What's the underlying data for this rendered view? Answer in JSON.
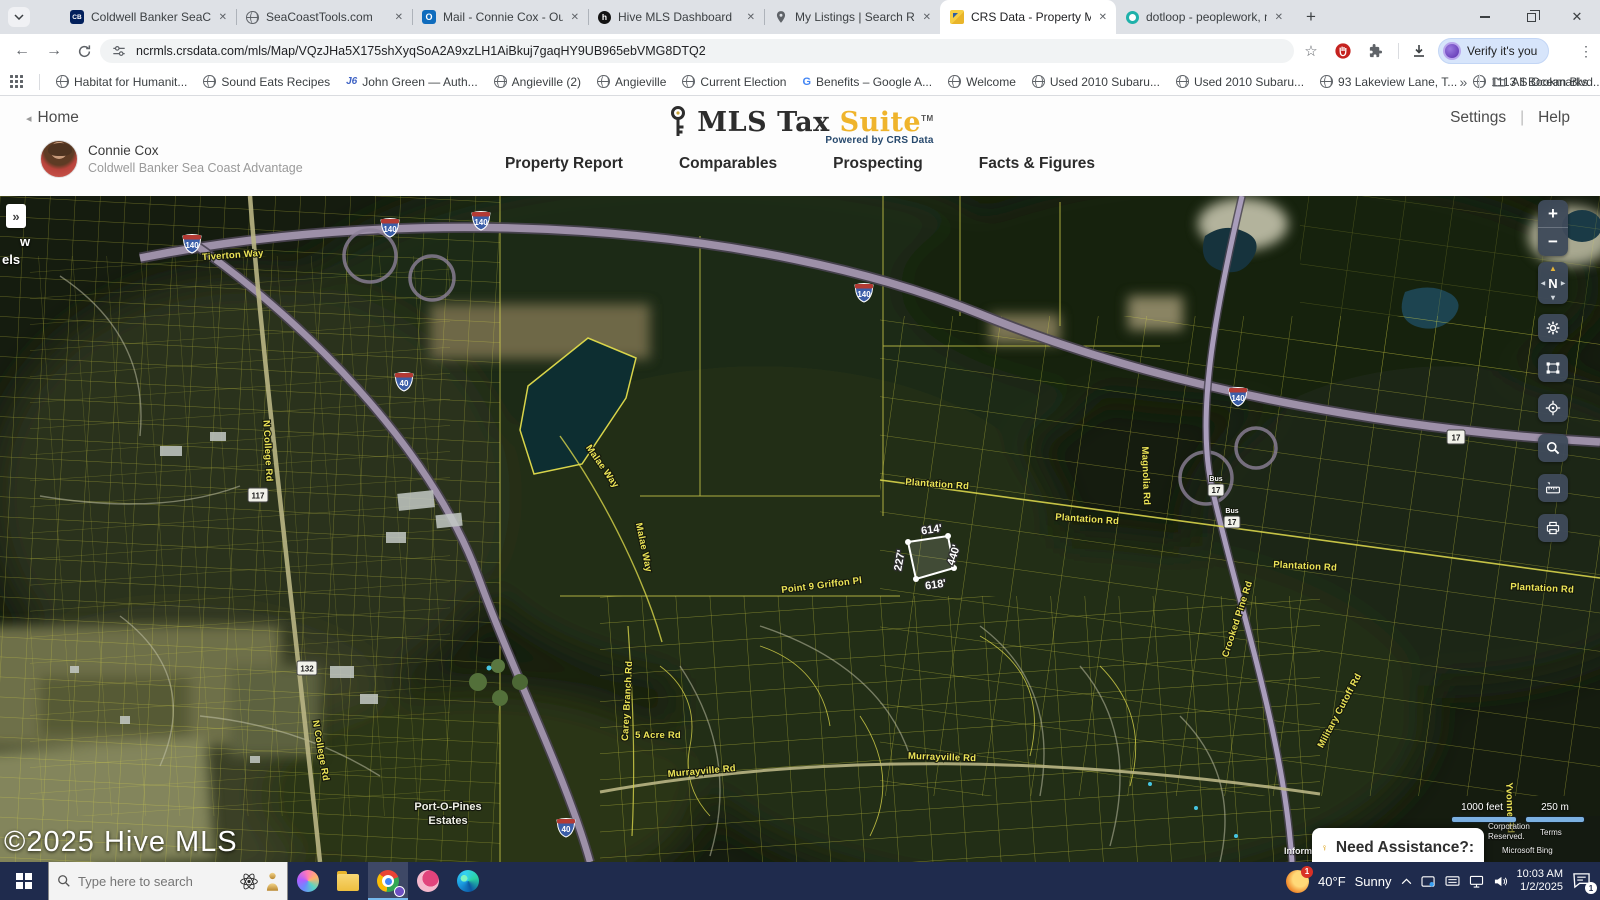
{
  "browser": {
    "tabs": [
      {
        "label": "Coldwell Banker SeaCoast Adva",
        "icon": "coldwell-banker"
      },
      {
        "label": "SeaCoastTools.com",
        "icon": "globe"
      },
      {
        "label": "Mail - Connie Cox - Outlook",
        "icon": "outlook"
      },
      {
        "label": "Hive MLS Dashboard",
        "icon": "hive"
      },
      {
        "label": "My Listings | Search Results | fle",
        "icon": "map-pin"
      },
      {
        "label": "CRS Data - Property Map for",
        "icon": "crs-gold"
      },
      {
        "label": "dotloop - peoplework, not pap",
        "icon": "dotloop-ring"
      }
    ],
    "close_glyph": "✕",
    "new_tab_glyph": "+",
    "nav_url": "ncrmls.crsdata.com/mls/Map/VQzJHa5X175shXyqSoA2A9xzLH1AiBkuj7gaqHY9UB965ebVMG8DTQ2",
    "verify_button": "Verify it's you",
    "bookmarks": [
      {
        "label": "Habitat for Humanit...",
        "icon": "globe"
      },
      {
        "label": "Sound Eats Recipes",
        "icon": "globe"
      },
      {
        "label": "John Green — Auth...",
        "icon": "jg"
      },
      {
        "label": "Angieville (2)",
        "icon": "globe"
      },
      {
        "label": "Angieville",
        "icon": "globe"
      },
      {
        "label": "Current Election",
        "icon": "globe"
      },
      {
        "label": "Benefits – Google A...",
        "icon": "google-g"
      },
      {
        "label": "Welcome",
        "icon": "globe"
      },
      {
        "label": "Used 2010 Subaru...",
        "icon": "globe"
      },
      {
        "label": "Used 2010 Subaru...",
        "icon": "globe"
      },
      {
        "label": "93 Lakeview Lane, T...",
        "icon": "globe"
      },
      {
        "label": "1113 S Ocean Blvd...",
        "icon": "globe"
      }
    ],
    "bookmarks_overflow": "»",
    "all_bookmarks": "All Bookmarks"
  },
  "header": {
    "back_link": "Home",
    "user": {
      "name": "Connie Cox",
      "company": "Coldwell Banker Sea Coast Advantage"
    },
    "logo": {
      "title_dark": "MLS Tax ",
      "title_gold": "Suite",
      "tm": "TM",
      "tagline": "Powered by CRS Data"
    },
    "links": {
      "settings": "Settings",
      "divider": "|",
      "help": "Help"
    },
    "nav": [
      "Property Report",
      "Comparables",
      "Prospecting",
      "Facts & Figures"
    ]
  },
  "map": {
    "copyright": "©2025 Hive MLS",
    "panel_toggle": "»",
    "edge_fragments": [
      "w",
      "els"
    ],
    "scale": {
      "feet": "1000 feet",
      "meters": "250 m"
    },
    "attribution": {
      "line1": "Corporation",
      "line2": "Reserved.",
      "line3": "Terms",
      "line4": "Microsoft Bing",
      "partial": "Inform"
    },
    "assistance_label": "Need Assistance?:",
    "controls": {
      "zoom_in": "+",
      "zoom_out": "−",
      "compass": "N"
    },
    "parcel": {
      "top": "614'",
      "bottom": "618'",
      "left": "227'",
      "right": "440'"
    },
    "shield_labels": [
      "140",
      "140",
      "140",
      "140",
      "140",
      "40",
      "40",
      "17",
      "117",
      "132",
      "Bus",
      "17",
      "Bus",
      "17"
    ],
    "road_labels": [
      "Tiverton Way",
      "N College Rd",
      "N College Rd",
      "Malae Way",
      "Malae Way",
      "Plantation Rd",
      "Plantation Rd",
      "Plantation Rd",
      "Plantation Rd",
      "Point 9 Griffon Pl",
      "Murrayville Rd",
      "Murrayville Rd",
      "5 Acre Rd",
      "Carey Branch Rd",
      "Crooked Pine Rd",
      "Magnolia Rd",
      "Military Cutoff Rd",
      "Yvonne Rd",
      "Port-O-Pines",
      "Estates"
    ]
  },
  "taskbar": {
    "search_placeholder": "Type here to search",
    "weather": {
      "temp": "40°F",
      "condition": "Sunny",
      "badge": "1"
    },
    "clock": {
      "time": "10:03 AM",
      "date": "1/2/2025"
    },
    "notifications_badge": "1"
  }
}
